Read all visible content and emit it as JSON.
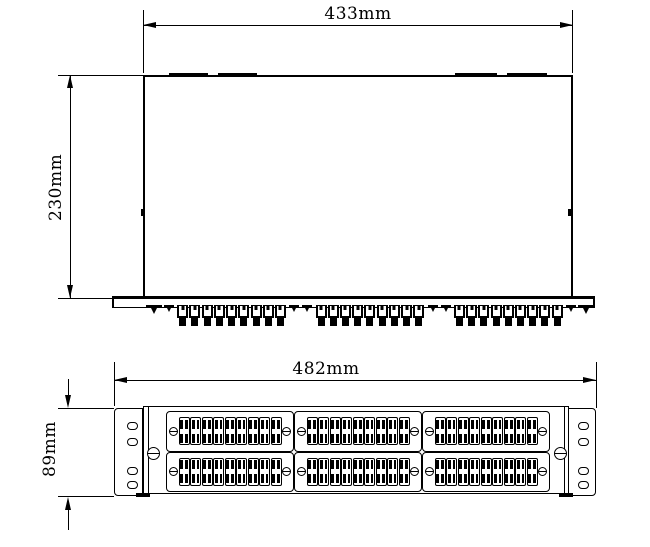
{
  "colors": {
    "line": "#000000",
    "background": "#ffffff"
  },
  "top_view": {
    "width_dim_label": "433mm",
    "height_dim_label": "230mm",
    "vent_slots": 4,
    "connector_groups": [
      9,
      9,
      9
    ],
    "feet": 2,
    "panel_screws": 6
  },
  "front_view": {
    "width_dim_label": "482mm",
    "height_dim_label": "89mm",
    "plate_rows": 2,
    "plate_cols": 3,
    "adapters_per_plate": 9,
    "ear_holes_per_ear": 4,
    "captive_screws": 2
  }
}
